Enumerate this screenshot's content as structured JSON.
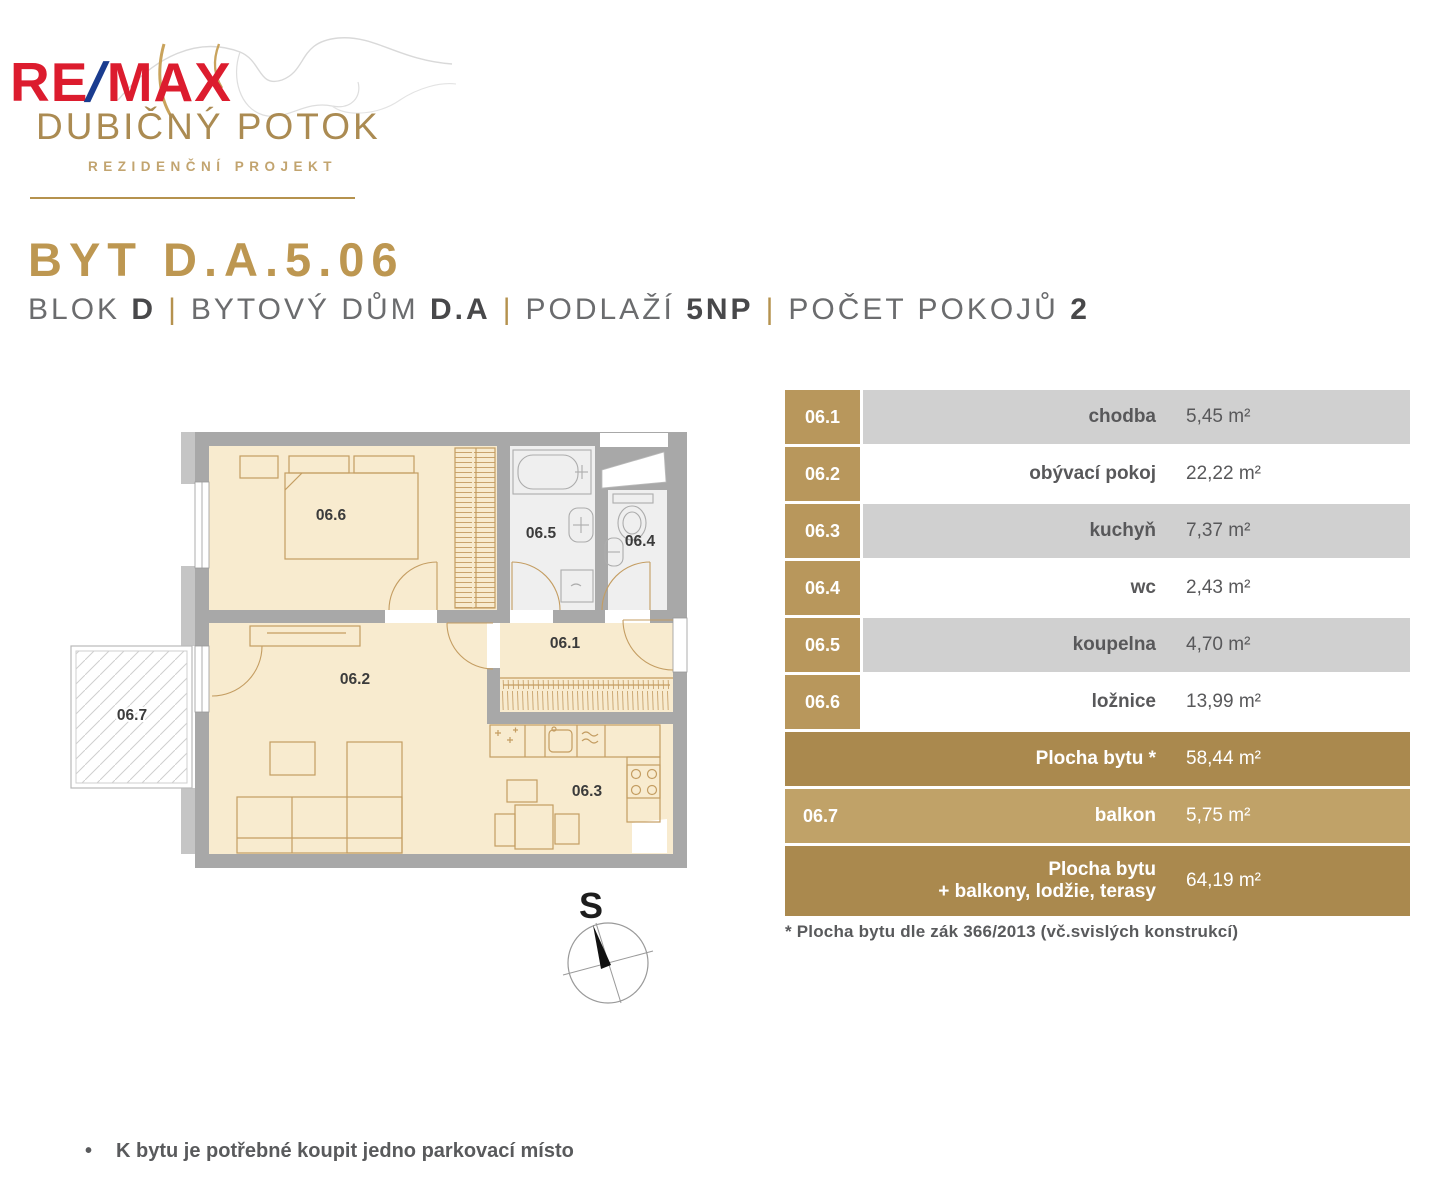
{
  "brand": {
    "remax_re": "RE",
    "remax_slash": "/",
    "remax_max": "MAX",
    "project": "DUBIČNÝ POTOK",
    "tagline": "REZIDENČNÍ PROJEKT"
  },
  "header": {
    "title": "BYT D.A.5.06",
    "separator": "|",
    "parts": [
      {
        "label": "BLOK",
        "value": "D"
      },
      {
        "label": "BYTOVÝ DŮM",
        "value": "D.A"
      },
      {
        "label": "PODLAŽÍ",
        "value": "5NP"
      },
      {
        "label": "POČET POKOJŮ",
        "value": "2"
      }
    ]
  },
  "floorplan": {
    "compass_label": "S",
    "room_labels": [
      "06.1",
      "06.2",
      "06.3",
      "06.4",
      "06.5",
      "06.6",
      "06.7"
    ]
  },
  "table": {
    "rows": [
      {
        "num": "06.1",
        "name": "chodba",
        "area": "5,45 m²",
        "shade": "gray"
      },
      {
        "num": "06.2",
        "name": "obývací pokoj",
        "area": "22,22 m²",
        "shade": "white"
      },
      {
        "num": "06.3",
        "name": "kuchyň",
        "area": "7,37 m²",
        "shade": "gray"
      },
      {
        "num": "06.4",
        "name": "wc",
        "area": "2,43 m²",
        "shade": "white"
      },
      {
        "num": "06.5",
        "name": "koupelna",
        "area": "4,70 m²",
        "shade": "gray"
      },
      {
        "num": "06.6",
        "name": "ložnice",
        "area": "13,99 m²",
        "shade": "white"
      }
    ],
    "summary": [
      {
        "num": "",
        "name_lines": [
          "Plocha bytu *"
        ],
        "area": "58,44 m²",
        "variant": "dark",
        "tall": false
      },
      {
        "num": "06.7",
        "name_lines": [
          "balkon"
        ],
        "area": "5,75 m²",
        "variant": "light",
        "tall": false
      },
      {
        "num": "",
        "name_lines": [
          "Plocha bytu",
          "+ balkony, lodžie, terasy"
        ],
        "area": "64,19 m²",
        "variant": "dark",
        "tall": true
      }
    ],
    "footnote": "* Plocha bytu dle zák 366/2013 (vč.svislých konstrukcí)"
  },
  "footer": {
    "bullet": "•",
    "note": "K bytu je potřebné koupit jedno parkovací místo"
  },
  "colors": {
    "remax_red": "#dc1c2e",
    "remax_blue": "#1a3c8f",
    "gold": "#b5924e",
    "gold_title": "#bd9751",
    "gold_cell": "#b8975c",
    "gold_dark_row": "#aa894e",
    "gold_light_row": "#c0a268",
    "row_gray": "#d0d0d0",
    "text_gray": "#58585a",
    "wall_gray": "#a8a8a8",
    "floor_beige": "#f8ebcf",
    "bath_floor": "#efefef"
  }
}
